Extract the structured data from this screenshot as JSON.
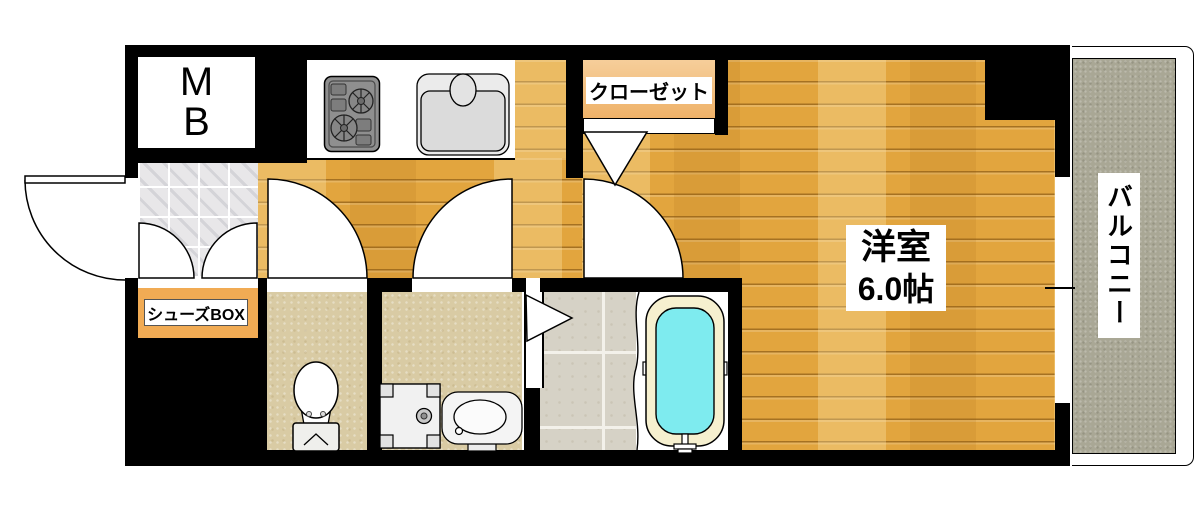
{
  "title": "one-room apartment floor plan",
  "labels": {
    "meter_box": "MB",
    "closet": "クローゼット",
    "western_room_name": "洋室",
    "western_room_size": "6.0帖",
    "balcony": "バルコニー",
    "shoes_box": "シューズBOX"
  },
  "fixtures": [
    "stove",
    "sink",
    "toilet",
    "washing-machine-pan",
    "wash-basin",
    "bathtub"
  ],
  "palette": {
    "wall": "#000000",
    "wood_floor": "#E2A53E",
    "wood_plank_light": "#ECB551",
    "entrance_tile": "#E8E7E9",
    "sanitary_floor": "#D9CBA4",
    "bath_tile": "#D6D2C6",
    "bathtub_water": "#7EEBEF",
    "bathtub_rim": "#F6F0CF",
    "closet_fill": "#F4C285",
    "shoes_box_fill": "#F1AB54",
    "balcony_floor": "#A9A795"
  }
}
